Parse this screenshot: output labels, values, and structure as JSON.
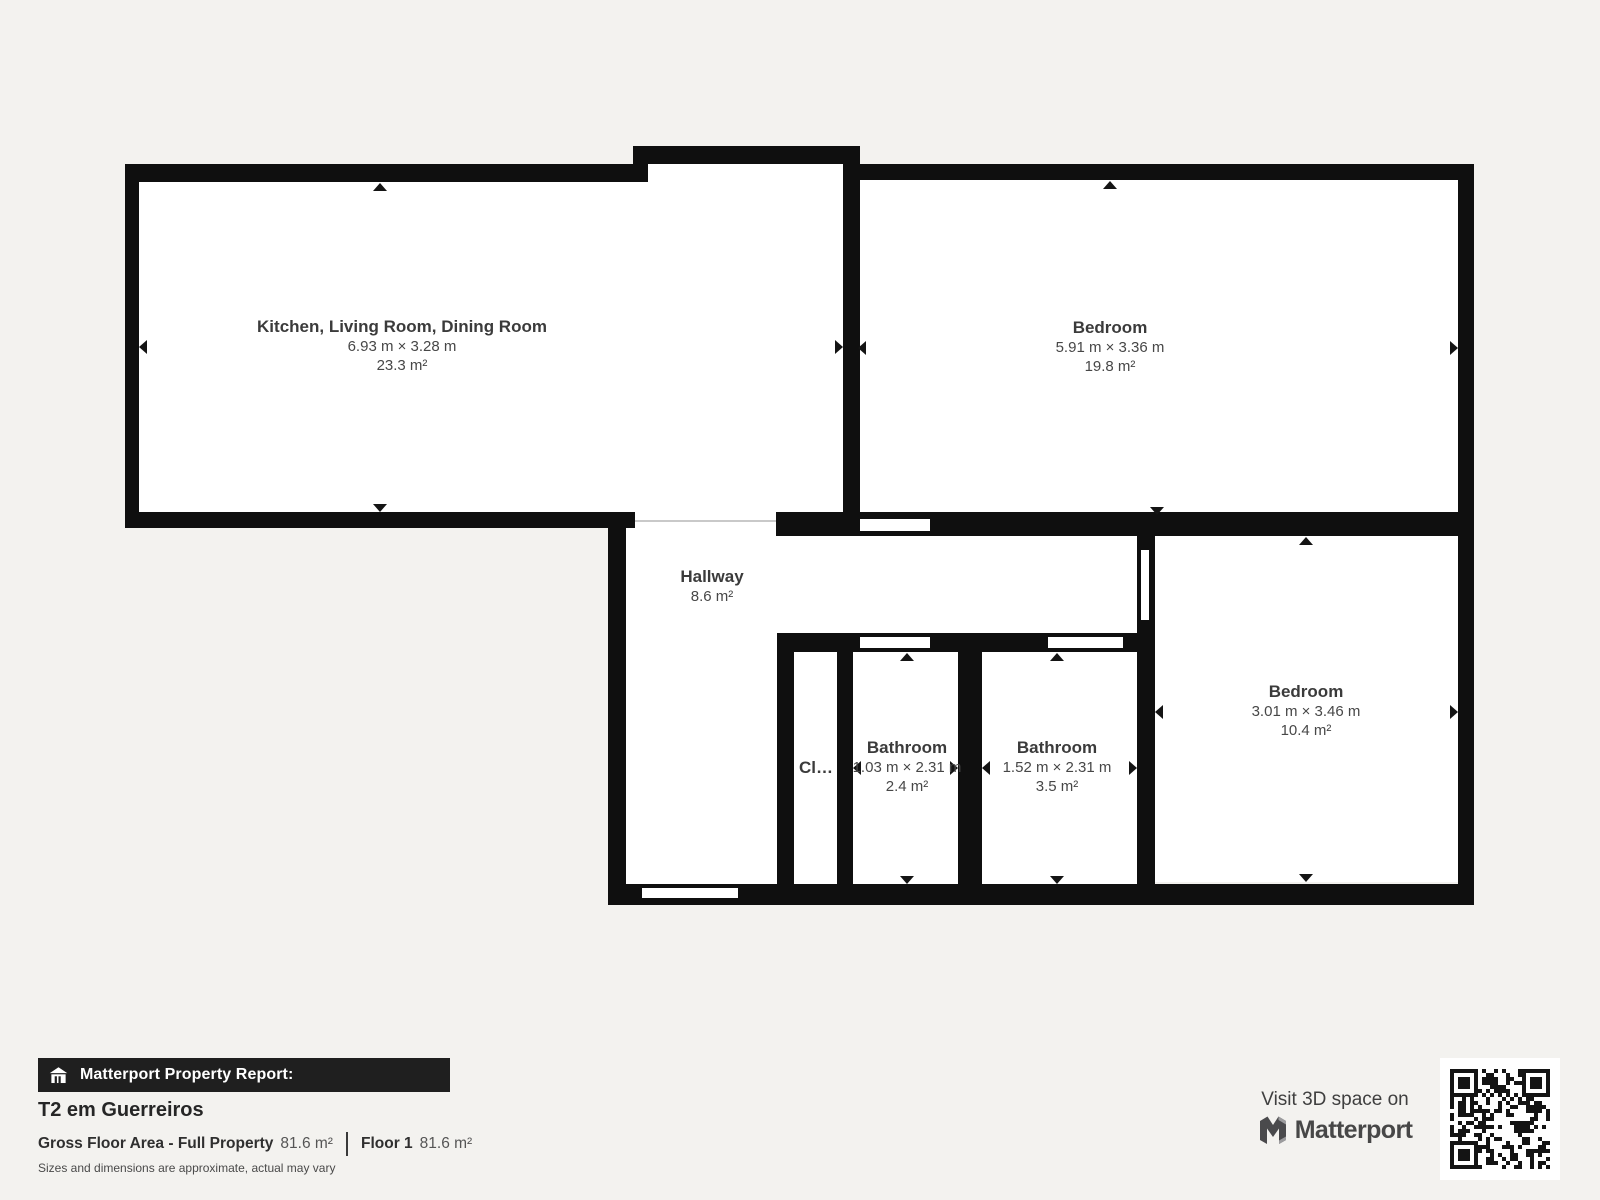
{
  "page": {
    "background": "#f3f2ef",
    "wall_color": "#0f0f0f",
    "room_fill": "#ffffff"
  },
  "plan": {
    "rooms": [
      {
        "id": "kitchen-living-dining",
        "name": "Kitchen, Living Room, Dining Room",
        "dims": "6.93 m × 3.28 m",
        "area": "23.3 m²"
      },
      {
        "id": "bedroom-1",
        "name": "Bedroom",
        "dims": "5.91 m × 3.36 m",
        "area": "19.8 m²"
      },
      {
        "id": "hallway",
        "name": "Hallway",
        "area": "8.6 m²"
      },
      {
        "id": "closet",
        "name": "Cl…"
      },
      {
        "id": "bathroom-1",
        "name": "Bathroom",
        "dims": "1.03 m × 2.31 m",
        "area": "2.4 m²"
      },
      {
        "id": "bathroom-2",
        "name": "Bathroom",
        "dims": "1.52 m × 2.31 m",
        "area": "3.5 m²"
      },
      {
        "id": "bedroom-2",
        "name": "Bedroom",
        "dims": "3.01 m × 3.46 m",
        "area": "10.4 m²"
      }
    ]
  },
  "footer": {
    "report_label": "Matterport Property Report:",
    "property_name": "T2 em Guerreiros",
    "gross_area_label": "Gross Floor Area - Full Property",
    "gross_area_value": "81.6 m²",
    "floor_label": "Floor 1",
    "floor_value": "81.6 m²",
    "disclaimer": "Sizes and dimensions are approximate, actual may vary"
  },
  "cta": {
    "visit_label": "Visit 3D space on",
    "brand_name": "Matterport",
    "icons": [
      "matterport-logo-mark",
      "qr-code",
      "house-icon"
    ]
  }
}
